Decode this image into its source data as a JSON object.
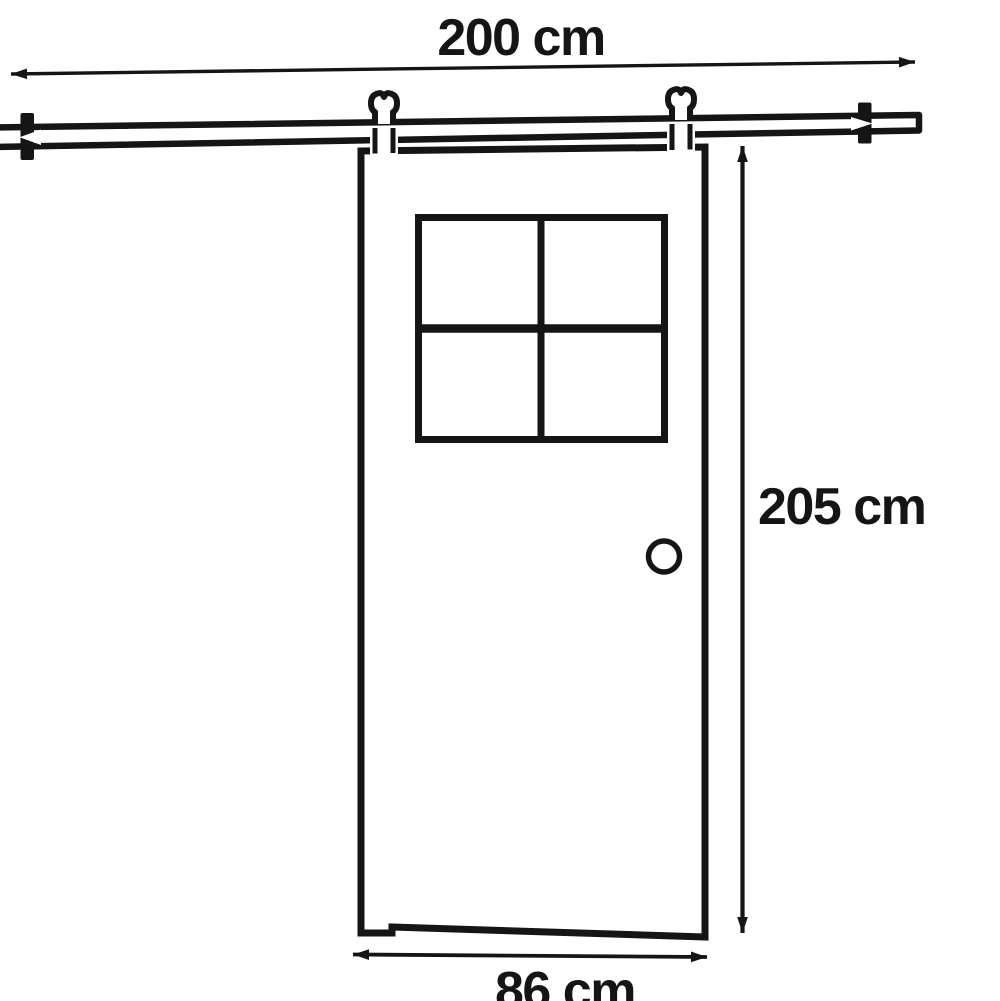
{
  "diagram": {
    "kind": "dimension-drawing",
    "subject": "sliding door with overhead track",
    "colors": {
      "background": "#ffffff",
      "line": "#151515"
    },
    "dimensions": {
      "track_width": {
        "label": "200 cm",
        "value": 200,
        "unit": "cm"
      },
      "door_height": {
        "label": "205 cm",
        "value": 205,
        "unit": "cm"
      },
      "door_width": {
        "label": "86 cm",
        "value": 86,
        "unit": "cm"
      }
    },
    "features": {
      "window_panes": 4,
      "hangers": 2,
      "end_stops": 2,
      "knob": 1
    }
  }
}
